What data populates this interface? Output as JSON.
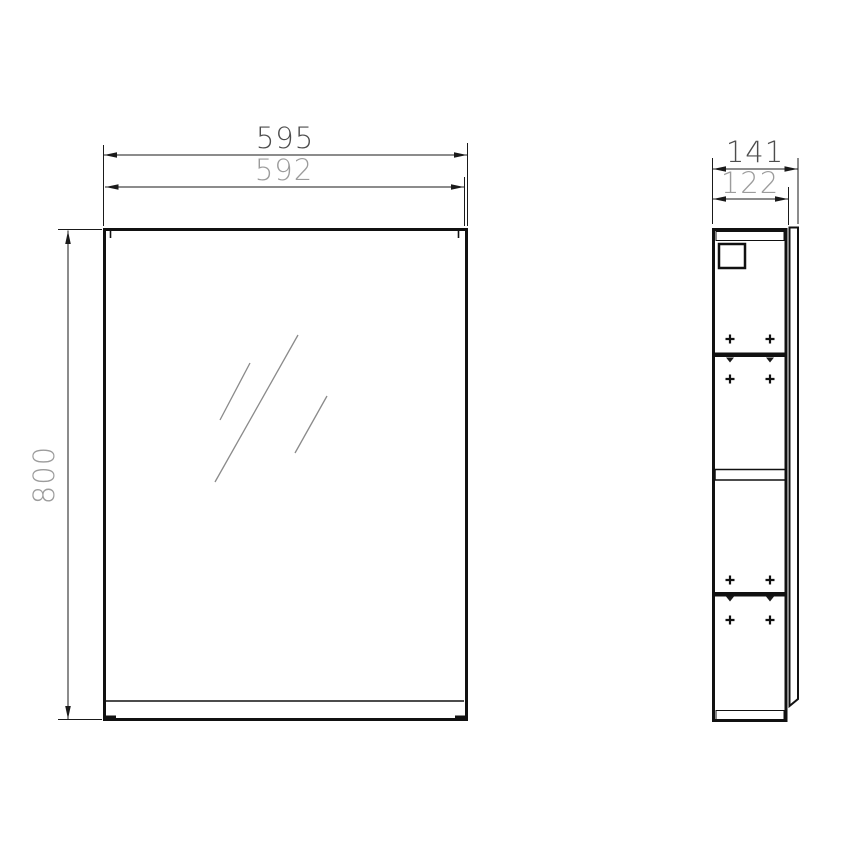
{
  "drawing": {
    "title": "mirror-cabinet-dimension-drawing",
    "front_view": {
      "dim_width_overall": "595",
      "dim_width_door": "592",
      "dim_height": "800"
    },
    "side_view": {
      "dim_depth_overall": "141",
      "dim_depth_carcass": "122"
    },
    "colors": {
      "background": "#ffffff",
      "line": "#111111",
      "dim_text_dark": "#4d4d4d",
      "dim_text_light": "#9c9c9c",
      "glass_line": "#8a8a8a"
    }
  }
}
